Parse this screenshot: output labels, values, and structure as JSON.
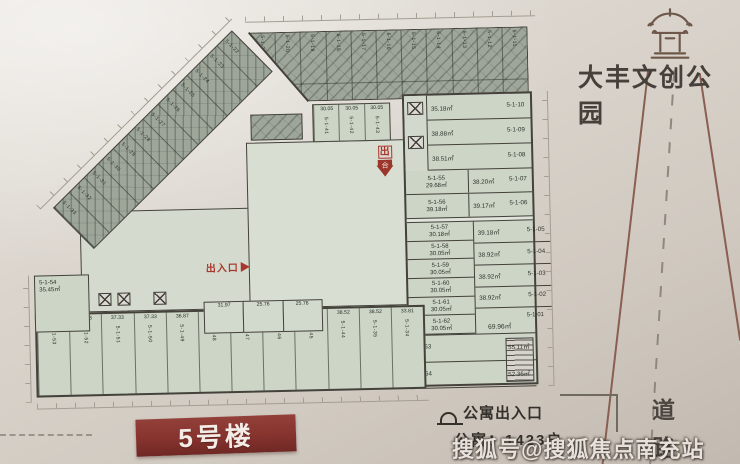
{
  "header": {
    "title": "大丰文创公园"
  },
  "banner": {
    "label": "5号楼"
  },
  "legend": {
    "entrance_label": "公寓出入口",
    "units_total": "公寓：1423户"
  },
  "road": {
    "char1": "道",
    "char2": "路"
  },
  "watermark": {
    "text": "搜狐号@搜狐焦点南充站"
  },
  "markers": {
    "exit_text": "出入口",
    "stamp_top": "出",
    "stamp_bottom": "合"
  },
  "colors": {
    "banner_red": "#86332e",
    "marker_red": "#a8382e",
    "unit_fill_green": "#ccd5c6",
    "hatched_wing": "#9ea69a",
    "paper": "#d8d2ca"
  },
  "plan": {
    "building_label": "5号楼",
    "top_wing_units": [
      {
        "id": "5-1-21"
      },
      {
        "id": "5-1-20"
      },
      {
        "id": "5-1-19"
      },
      {
        "id": "5-1-18"
      },
      {
        "id": "5-1-17"
      },
      {
        "id": "5-1-16"
      },
      {
        "id": "5-1-15"
      },
      {
        "id": "5-1-14"
      },
      {
        "id": "5-1-13"
      },
      {
        "id": "5-1-12"
      },
      {
        "id": "5-1-11"
      }
    ],
    "diagonal_units": [
      {
        "id": "5-1-33"
      },
      {
        "id": "5-1-32"
      },
      {
        "id": "5-1-31"
      },
      {
        "id": "5-1-30"
      },
      {
        "id": "5-1-29"
      },
      {
        "id": "5-1-28"
      },
      {
        "id": "5-1-27"
      },
      {
        "id": "5-1-26"
      },
      {
        "id": "5-1-25"
      },
      {
        "id": "5-1-24"
      },
      {
        "id": "5-1-23"
      },
      {
        "id": "5-1-22"
      }
    ],
    "mid_strip_units": [
      {
        "id": "5-1-41",
        "area": "30.05"
      },
      {
        "id": "5-1-42",
        "area": "30.05"
      },
      {
        "id": "5-1-43",
        "area": "30.05"
      }
    ],
    "right_upper_rows": [
      {
        "id": "5-1-10",
        "area": "35.18㎡"
      },
      {
        "id": "5-1-09",
        "area": "38.88㎡"
      },
      {
        "id": "5-1-08",
        "area": "38.51㎡"
      }
    ],
    "right_upper_pairs": [
      {
        "left_id": "5-1-55",
        "left_area": "29.68㎡",
        "id": "5-1-07",
        "area": "38.20㎡"
      },
      {
        "left_id": "5-1-56",
        "left_area": "39.18㎡",
        "id": "5-1-06",
        "area": "39.17㎡"
      }
    ],
    "right_lower_left": [
      {
        "id": "5-1-57",
        "area": "30.18㎡"
      },
      {
        "id": "5-1-58",
        "area": "30.05㎡"
      },
      {
        "id": "5-1-59",
        "area": "30.05㎡"
      },
      {
        "id": "5-1-60",
        "area": "30.05㎡"
      },
      {
        "id": "5-1-61",
        "area": "30.05㎡"
      },
      {
        "id": "5-1-62",
        "area": "30.05㎡"
      }
    ],
    "right_lower_right": [
      {
        "id": "5-1-05",
        "area": "39.18㎡"
      },
      {
        "id": "5-1-04",
        "area": "38.92㎡"
      },
      {
        "id": "5-1-03",
        "area": "38.92㎡"
      },
      {
        "id": "5-1-02",
        "area": "38.92㎡"
      },
      {
        "id": "5-1-01",
        "area": "69.96㎡",
        "big": true
      }
    ],
    "right_bottom_rows": [
      {
        "id": "5-1-63",
        "area": "55.11㎡"
      },
      {
        "id": "5-1-64",
        "area": "52.36㎡"
      }
    ],
    "left_unit": {
      "id": "5-1-54",
      "area": "35.45㎡"
    },
    "mid_sub_units": [
      {
        "area": "31.97"
      },
      {
        "area": "25.76"
      },
      {
        "area": "25.76"
      }
    ],
    "bottom_row_units": [
      {
        "id": "5-1-53",
        "area": "37.67"
      },
      {
        "id": "5-1-52",
        "area": "37.33"
      },
      {
        "id": "5-1-51",
        "area": "37.33"
      },
      {
        "id": "5-1-50",
        "area": "37.33"
      },
      {
        "id": "5-1-49",
        "area": "36.87"
      },
      {
        "id": "5-1-48",
        "area": "20.70"
      },
      {
        "id": "5-1-47",
        "area": "34.84"
      },
      {
        "id": "5-1-46",
        "area": "37.02"
      },
      {
        "id": "5-1-45",
        "area": "39.13"
      },
      {
        "id": "5-1-44",
        "area": "38.52"
      },
      {
        "id": "5-1-35",
        "area": "38.52"
      },
      {
        "id": "5-1-34",
        "area": "33.81"
      }
    ]
  }
}
